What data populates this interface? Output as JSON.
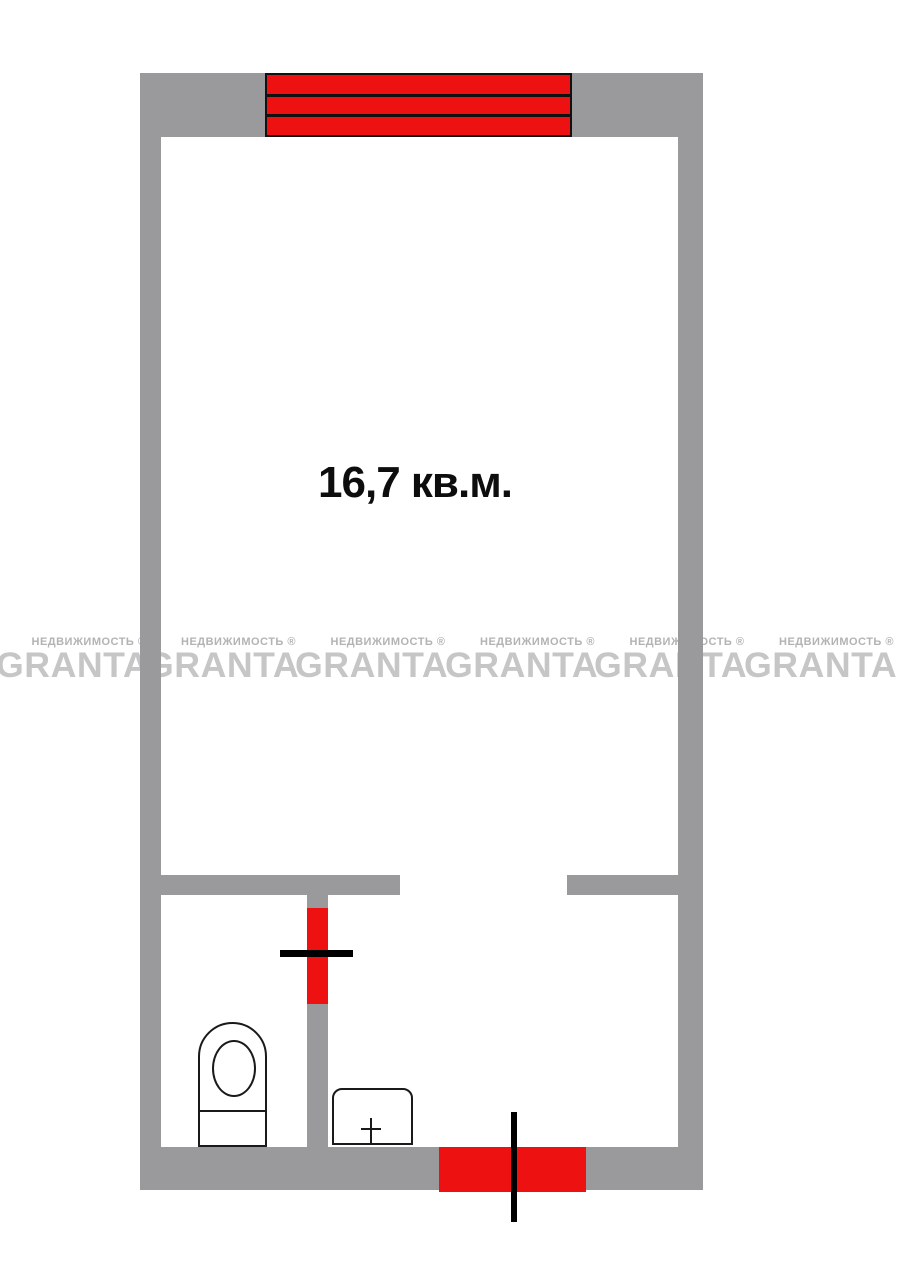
{
  "plan": {
    "area_label": "16,7 кв.м.",
    "fixtures": [
      "toilet",
      "sink"
    ],
    "features": [
      "window",
      "bathroom-door",
      "entry-door"
    ]
  },
  "watermark": {
    "brand": "GRANTA",
    "subtitle": "НЕДВИЖИМОСТЬ ®",
    "repeat_count": 6
  },
  "colors": {
    "background": "#ffffff",
    "wall_gray": "#9a9a9c",
    "accent_red": "#ee1111",
    "line_black": "#111111",
    "watermark_brand": "#c6c6c6",
    "watermark_subtitle": "#b3b3b3"
  }
}
